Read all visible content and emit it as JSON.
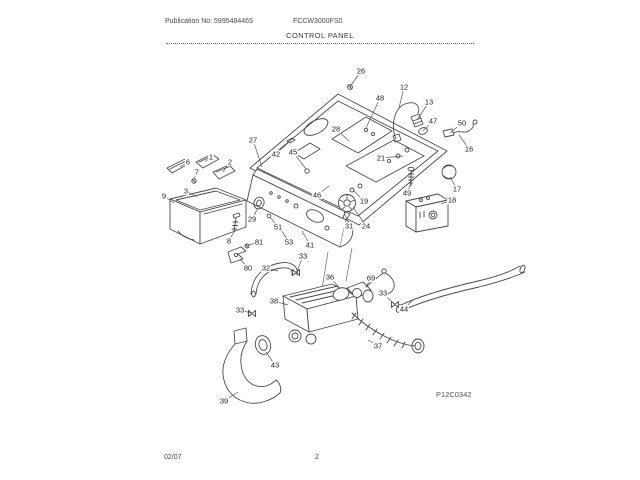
{
  "header": {
    "publication_no": "Publication No: 5995484465",
    "model_no": "FCCW3000FS0",
    "section_title": "CONTROL PANEL"
  },
  "diagram": {
    "code": "P12C0342",
    "ink_color": "#4a4a4a",
    "callouts": [
      {
        "label": "26",
        "x": 361,
        "y": 71,
        "tx": 350,
        "ty": 87
      },
      {
        "label": "12",
        "x": 404,
        "y": 87,
        "tx": 399,
        "ty": 108
      },
      {
        "label": "48",
        "x": 380,
        "y": 98,
        "tx": 366,
        "ty": 128
      },
      {
        "label": "13",
        "x": 429,
        "y": 102,
        "tx": 417,
        "ty": 120
      },
      {
        "label": "28",
        "x": 336,
        "y": 129,
        "tx": 349,
        "ty": 141
      },
      {
        "label": "47",
        "x": 433,
        "y": 121,
        "tx": 423,
        "ty": 131
      },
      {
        "label": "50",
        "x": 462,
        "y": 123,
        "tx": 450,
        "ty": 133
      },
      {
        "label": "16",
        "x": 469,
        "y": 149,
        "tx": 459,
        "ty": 135
      },
      {
        "label": "27",
        "x": 253,
        "y": 140,
        "tx": 262,
        "ty": 167
      },
      {
        "label": "42",
        "x": 276,
        "y": 154,
        "tx": 288,
        "ty": 143
      },
      {
        "label": "45",
        "x": 293,
        "y": 152,
        "tx": 306,
        "ty": 169
      },
      {
        "label": "21",
        "x": 381,
        "y": 158,
        "tx": 403,
        "ty": 156
      },
      {
        "label": "1",
        "x": 211,
        "y": 157,
        "tx": 205,
        "ty": 162
      },
      {
        "label": "2",
        "x": 230,
        "y": 162,
        "tx": 223,
        "ty": 172
      },
      {
        "label": "6",
        "x": 188,
        "y": 162,
        "tx": 180,
        "ty": 167
      },
      {
        "label": "7",
        "x": 197,
        "y": 172,
        "tx": 194,
        "ty": 179
      },
      {
        "label": "3",
        "x": 186,
        "y": 191,
        "tx": 197,
        "ty": 197
      },
      {
        "label": "9",
        "x": 164,
        "y": 196,
        "tx": 174,
        "ty": 203
      },
      {
        "label": "29",
        "x": 252,
        "y": 219,
        "tx": 258,
        "ty": 208
      },
      {
        "label": "51",
        "x": 278,
        "y": 227,
        "tx": 270,
        "ty": 217
      },
      {
        "label": "53",
        "x": 289,
        "y": 242,
        "tx": 281,
        "ty": 230
      },
      {
        "label": "41",
        "x": 310,
        "y": 245,
        "tx": 302,
        "ty": 231
      },
      {
        "label": "33",
        "x": 303,
        "y": 256,
        "tx": 296,
        "ty": 274
      },
      {
        "label": "46",
        "x": 317,
        "y": 195,
        "tx": 329,
        "ty": 186
      },
      {
        "label": "19",
        "x": 364,
        "y": 201,
        "tx": 353,
        "ty": 190
      },
      {
        "label": "31",
        "x": 349,
        "y": 226,
        "tx": 344,
        "ty": 212
      },
      {
        "label": "24",
        "x": 366,
        "y": 226,
        "tx": 353,
        "ty": 207
      },
      {
        "label": "49",
        "x": 407,
        "y": 193,
        "tx": 411,
        "ty": 183
      },
      {
        "label": "17",
        "x": 457,
        "y": 189,
        "tx": 450,
        "ty": 177
      },
      {
        "label": "18",
        "x": 452,
        "y": 200,
        "tx": 441,
        "ty": 204
      },
      {
        "label": "8",
        "x": 229,
        "y": 241,
        "tx": 235,
        "ty": 230
      },
      {
        "label": "81",
        "x": 259,
        "y": 242,
        "tx": 249,
        "ty": 245
      },
      {
        "label": "80",
        "x": 248,
        "y": 268,
        "tx": 240,
        "ty": 259
      },
      {
        "label": "32",
        "x": 266,
        "y": 268,
        "tx": 278,
        "ty": 271
      },
      {
        "label": "38",
        "x": 274,
        "y": 301,
        "tx": 288,
        "ty": 305
      },
      {
        "label": "33",
        "x": 240,
        "y": 310,
        "tx": 251,
        "ty": 313
      },
      {
        "label": "36",
        "x": 330,
        "y": 277,
        "tx": 340,
        "ty": 289
      },
      {
        "label": "69",
        "x": 371,
        "y": 278,
        "tx": 366,
        "ty": 287
      },
      {
        "label": "33",
        "x": 383,
        "y": 293,
        "tx": 394,
        "ty": 304
      },
      {
        "label": "44",
        "x": 404,
        "y": 309,
        "tx": 413,
        "ty": 300
      },
      {
        "label": "37",
        "x": 378,
        "y": 346,
        "tx": 368,
        "ty": 340
      },
      {
        "label": "43",
        "x": 275,
        "y": 365,
        "tx": 266,
        "ty": 352
      },
      {
        "label": "39",
        "x": 224,
        "y": 401,
        "tx": 238,
        "ty": 392
      }
    ]
  },
  "footer": {
    "date": "02/07",
    "page": "2"
  }
}
